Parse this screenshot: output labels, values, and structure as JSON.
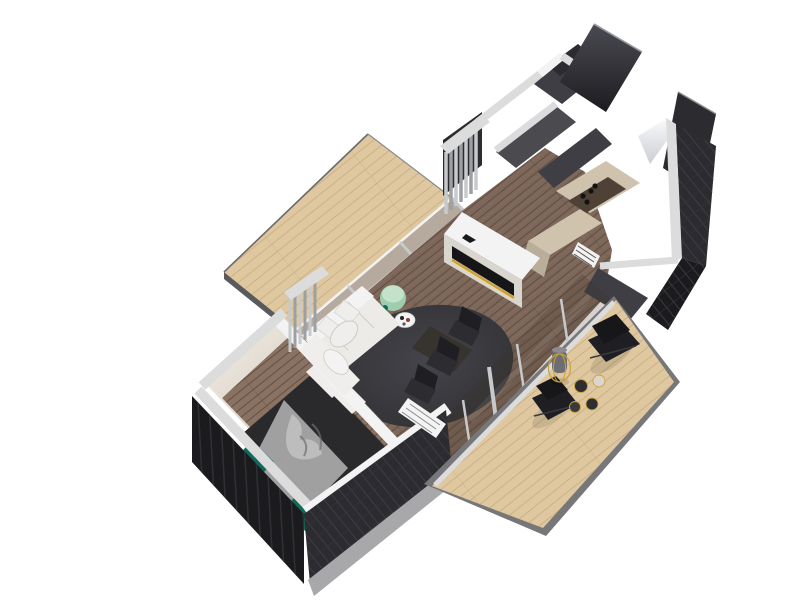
{
  "scene": {
    "description": "Isometric 3D render of a modular one-bedroom home floor plan: dark angular exterior shell cut away to white wall tops, dark timber interior flooring, and two light timber terraces attached diagonally at upper-left and lower-right.",
    "style": "architectural 3D cutaway floor plan on white background"
  },
  "colors": {
    "background": "#ffffff",
    "deck_wood": "#dfc8a0",
    "deck_plank_line": "#c3a97d",
    "deck_rim": "#77777a",
    "floor_wood": "#7d675a",
    "floor_plank_line": "#57473c",
    "bedroom_floor": "#8a7263",
    "white_wall": "#dcdcdc",
    "white_wall_bright": "#f3f3f4",
    "white_wall_dim": "#c4c4c6",
    "dark_wall": "#1b1b1e",
    "dark_wall_mid": "#2b2b30",
    "dark_wall_soft": "#3e3e44",
    "interior_wall": "#4a4a4f",
    "inner_wall_lit": "#efe9e0",
    "inner_wall_shade": "#ddd5c9",
    "glass_tint": "#51422f",
    "sofa": "#edebe7",
    "sofa_shadow": "#d9d6d0",
    "rug": "#3a3a3d",
    "bed_duvet": "#2a2a2d",
    "bed_throw": "#a0a0a0",
    "bed_teal": "#0d6b59",
    "pillow": "#efeeec",
    "amber_screen": "#e8a53c",
    "gold_accent": "#c9a23a",
    "mint_table": "#9fceae",
    "chair_black": "#1f1f23",
    "counter_beige": "#cfc3ae",
    "counter_dark": "#4f4136",
    "metal_silver": "#c7cacc"
  },
  "inventory": {
    "rooms": [
      "bedroom",
      "living-room",
      "dining-area",
      "kitchen",
      "bathroom",
      "entry"
    ],
    "decks": [
      "left-terrace",
      "right-terrace"
    ],
    "furniture": {
      "bed": 1,
      "bedroom_tv": 1,
      "sofa": 1,
      "round_rug": 1,
      "mint_side_table": 1,
      "media_cabinet_with_led": 1,
      "dining_table": 1,
      "dining_chairs": 3,
      "kitchen_counter_l_shape": 1,
      "cooktop_burners": 4,
      "lounge_chairs": 2,
      "floor_lamp": 1,
      "deck_side_tables": 4,
      "louver_radiator_panels": 2,
      "entry_door": 1
    }
  }
}
